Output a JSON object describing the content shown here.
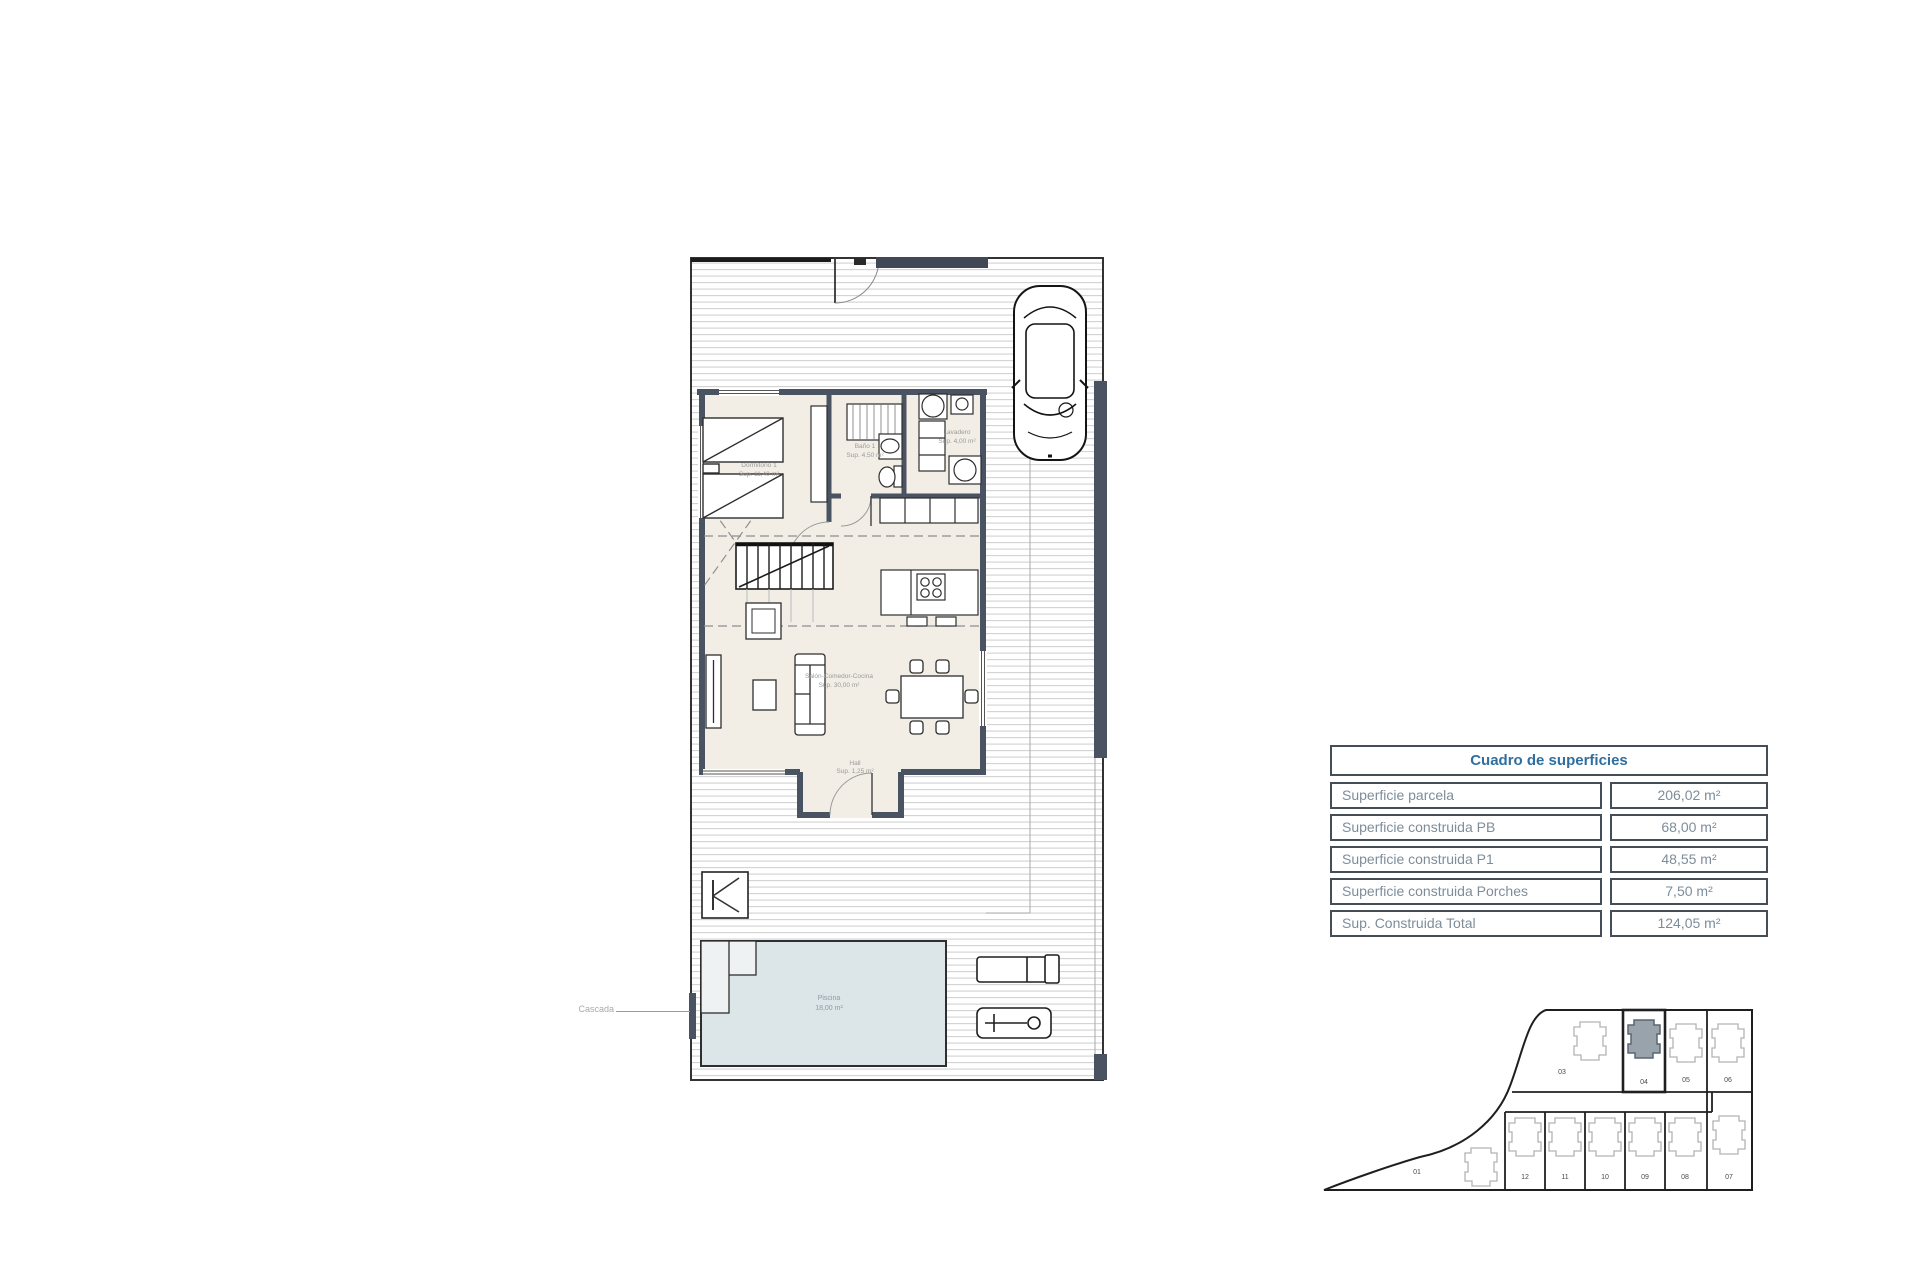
{
  "surface_table": {
    "title": "Cuadro de superficies",
    "rows": [
      {
        "label": "Superficie parcela",
        "value": "206,02 m²"
      },
      {
        "label": "Superficie construida PB",
        "value": "68,00 m²"
      },
      {
        "label": "Superficie construida P1",
        "value": "48,55 m²"
      },
      {
        "label": "Superficie construida Porches",
        "value": "7,50 m²"
      },
      {
        "label": "Sup. Construida Total",
        "value": "124,05 m²"
      }
    ]
  },
  "floor_plan": {
    "bedroom": {
      "name": "Dormitorio 1",
      "area": "Sup. 11,40 m²"
    },
    "bathroom": {
      "name": "Baño 1",
      "area": "Sup. 4,50 m²"
    },
    "laundry": {
      "name": "Lavadero",
      "area": "Sup. 4,00 m²"
    },
    "living": {
      "name": "Salón-Comedor-Cocina",
      "area": "Sup. 30,00 m²"
    },
    "hall": {
      "name": "Hall",
      "area": "Sup. 1,25 m²"
    },
    "pool": {
      "name": "Piscina",
      "area": "18,00 m²"
    },
    "waterfall": "Cascada"
  },
  "site_plan": {
    "large_plot": "01",
    "top_row": [
      "03",
      "04",
      "05",
      "06"
    ],
    "bottom_row": [
      "12",
      "11",
      "10",
      "09",
      "08",
      "07"
    ],
    "highlighted_plot": "04"
  },
  "colors": {
    "wall": "#4a5361",
    "pool_fill": "#dce6e8",
    "table_header_text": "#2f6f9f",
    "table_text": "#7d8d9a",
    "highlighted_house_fill": "#99a3ac"
  }
}
